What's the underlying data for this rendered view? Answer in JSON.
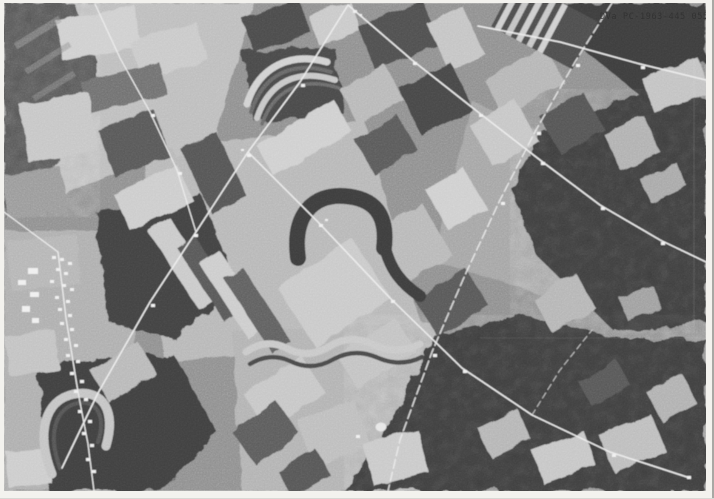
{
  "photo": {
    "stamp_text": "DVa PC-1963-445 055",
    "caption": "Black-and-white aerial survey photograph: patchwork farm fields, contour strip cropping, woodland, rural roads, small town at lower left.",
    "palette": {
      "paper_border": "#f3f2ee",
      "terrain_base": "#8f8f8f",
      "field_light": "#cccccc",
      "field_dark": "#4a4a4a",
      "forest": "#3e3e3e",
      "road": "#ececec",
      "stamp_ink": "#2f2f2f"
    }
  }
}
